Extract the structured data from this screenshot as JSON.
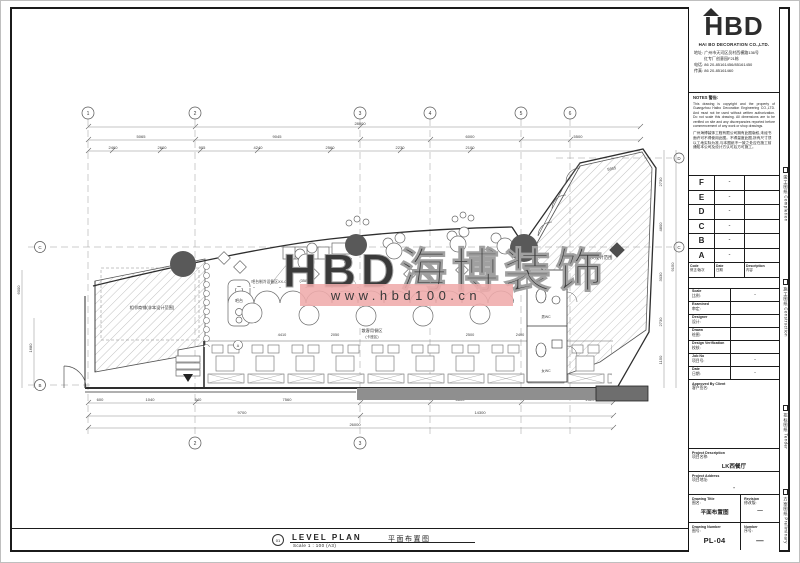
{
  "watermark": {
    "brand": "HBD海博装饰",
    "url": "www.hbd100.cn",
    "band_color": "#efabab"
  },
  "footer": {
    "marker": "01",
    "title_en": "LEVEL PLAN",
    "scale": "Scale 1 : 100 (A3)",
    "title_cn": "平面布置图"
  },
  "title_block": {
    "logo_text": "HBD",
    "company": "HAI BO DECORATION CO.,LTD.",
    "contact": {
      "address1": "地址: 广州市天河区员村西横路136号",
      "address2": "红专厂创意园F21栋",
      "phone": "电话: 86 20-85161456/85161450",
      "fax": "传真: 86 20-85161460"
    },
    "notes": {
      "title": "NOTES 警告:",
      "en": "This drawing is copyright and the property of Guangzhou Haibo Decoration Engineering CO.,LTD. And must not be used without written authorization. Do not scale this drawing. All dimensions are to be verified on site and any discrepancies reported before commencement of any work or shop drawings.",
      "cn": "广州海博装饰工程有限公司拥有此图版权,未经书面许可不得使用此图。不得量度此图,所有尺寸须以工地实际为准,与本图纸不一致之处应在施工前通知本公司及设计方认可后方可施工。"
    },
    "revisions": [
      {
        "code": "F",
        "date": "-"
      },
      {
        "code": "E",
        "date": "-"
      },
      {
        "code": "D",
        "date": "-"
      },
      {
        "code": "C",
        "date": "-"
      },
      {
        "code": "B",
        "date": "-"
      },
      {
        "code": "A",
        "date": "-"
      }
    ],
    "rev_header": {
      "code_en": "Code",
      "code_cn": "修正/版次",
      "date_en": "Date",
      "date_cn": "日期",
      "desc_en": "Description",
      "desc_cn": "内容"
    },
    "info_rows": [
      {
        "en": "Scale",
        "cn": "比例:",
        "value": "-"
      },
      {
        "en": "Examined",
        "cn": "审定:",
        "value": ""
      },
      {
        "en": "Designer",
        "cn": "设计:",
        "value": ""
      },
      {
        "en": "Drawn",
        "cn": "绘图:",
        "value": ""
      },
      {
        "en": "Design Verification",
        "cn": "校核:",
        "value": ""
      },
      {
        "en": "Job No",
        "cn": "项目号:",
        "value": "-"
      },
      {
        "en": "Date",
        "cn": "日期:",
        "value": "-"
      }
    ],
    "client": {
      "en": "Approved By Client",
      "cn": "客户签名:"
    },
    "project": {
      "en": "Project Description",
      "cn": "项目名称:",
      "value": "LK西餐厅"
    },
    "address": {
      "en": "Project Address",
      "cn": "项目地址:",
      "value": "-"
    },
    "drawing_title": {
      "en": "Drawing Title",
      "cn": "图名:",
      "value": "平面布置图"
    },
    "revision_cell": {
      "en": "Revision",
      "cn": "修改版:",
      "value": "—"
    },
    "drawing_number": {
      "en": "Drawing Number",
      "cn": "图号:",
      "value": "PL-04"
    },
    "number_cell": {
      "en": "Number",
      "cn": "序号:",
      "value": "—"
    }
  },
  "side_strip": [
    {
      "label": "竣工图纸 Completion"
    },
    {
      "label": "施工图纸 Construction"
    },
    {
      "label": "招标图纸 Tender"
    },
    {
      "label": "方案图纸 Preliminary"
    }
  ],
  "plan": {
    "labels": {
      "adjacent": "相邻商铺(非本设计范围)",
      "bar_note": "吧台制冷设备区XX-04",
      "bar": "吧台",
      "dining": "散客用餐区",
      "dining_sub": "(卡座区)",
      "scope": "非本次设计范围",
      "wc_m": "男WC",
      "wc_f": "女WC",
      "marker": "A"
    },
    "grid": {
      "top": [
        "1",
        "2",
        "3",
        "4",
        "5",
        "6"
      ],
      "bottom": [
        "2",
        "3"
      ],
      "left": [
        "C",
        "B"
      ],
      "right": [
        "D",
        "C"
      ]
    },
    "dims": {
      "overall_top": "28000",
      "top2": [
        "5065",
        "9045",
        "6000",
        "5500"
      ],
      "top3": [
        "2460",
        "2600",
        "905",
        "4240",
        "2560",
        "2230",
        "2100"
      ],
      "bottom1": [
        "600",
        "1040",
        "540",
        "7560",
        "6600",
        "2520"
      ],
      "bottom2": [
        "9700",
        "14300"
      ],
      "overall_bottom": "26000",
      "left": [
        "6000",
        "1680"
      ],
      "right": [
        "2730",
        "4800",
        "3030",
        "2730",
        "1150",
        "9150"
      ],
      "diag": "5865",
      "interior": [
        "4410",
        "2050",
        "2500",
        "2400",
        "(3580)"
      ]
    }
  }
}
